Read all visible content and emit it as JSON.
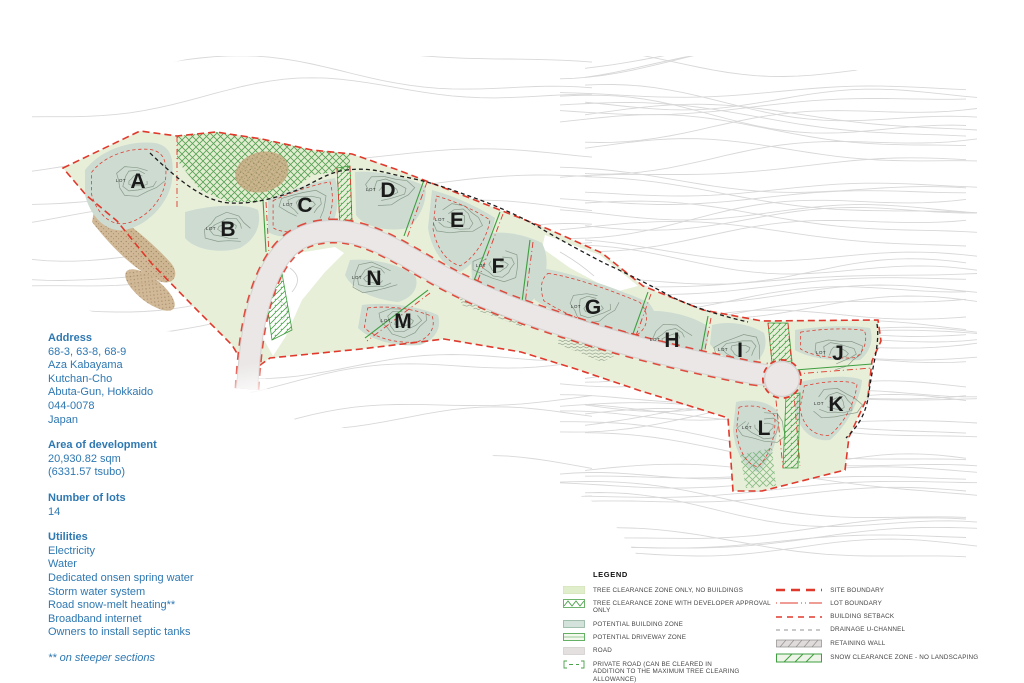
{
  "info_panel": {
    "address": {
      "title": "Address",
      "lines": [
        "68-3, 63-8, 68-9",
        "Aza Kabayama",
        "Kutchan-Cho",
        "Abuta-Gun, Hokkaido",
        "044-0078",
        "Japan"
      ]
    },
    "area": {
      "title": "Area of development",
      "lines": [
        "20,930.82 sqm",
        "(6331.57 tsubo)"
      ]
    },
    "number_of_lots": {
      "title": "Number of lots",
      "value": "14"
    },
    "utilities": {
      "title": "Utilities",
      "lines": [
        "Electricity",
        "Water",
        "Dedicated onsen spring water",
        "Storm water system",
        "Road snow-melt heating**",
        "Broadband internet",
        "Owners to install septic tanks"
      ]
    },
    "footnote": "** on steeper sections"
  },
  "legend": {
    "title": "LEGEND",
    "left_items": [
      {
        "label": "TREE CLEARANCE ZONE ONLY, NO BUILDINGS",
        "swatch": "tree-clearance-zone"
      },
      {
        "label": "TREE CLEARANCE ZONE WITH DEVELOPER APPROVAL ONLY",
        "swatch": "tree-clearance-developer-zone"
      },
      {
        "label": "POTENTIAL BUILDING ZONE",
        "swatch": "potential-building-zone"
      },
      {
        "label": "POTENTIAL DRIVEWAY ZONE",
        "swatch": "potential-driveway-zone"
      },
      {
        "label": "ROAD",
        "swatch": "road"
      },
      {
        "label": "PRIVATE ROAD (CAN BE CLEARED IN ADDITION TO THE MAXIMUM TREE CLEARING ALLOWANCE)",
        "swatch": "private-road"
      }
    ],
    "right_items": [
      {
        "label": "SITE BOUNDARY",
        "swatch": "site-boundary"
      },
      {
        "label": "LOT BOUNDARY",
        "swatch": "lot-boundary"
      },
      {
        "label": "BUILDING SETBACK",
        "swatch": "building-setback"
      },
      {
        "label": "DRAINAGE U-CHANNEL",
        "swatch": "drainage-u-channel"
      },
      {
        "label": "RETAINING WALL",
        "swatch": "retaining-wall"
      },
      {
        "label": "SNOW CLEARANCE ZONE - NO LANDSCAPING",
        "swatch": "snow-clearance-zone"
      }
    ]
  },
  "map": {
    "lot_prefix": "LOT",
    "lots": [
      "A",
      "B",
      "C",
      "D",
      "E",
      "F",
      "G",
      "H",
      "I",
      "J",
      "K",
      "L",
      "M",
      "N"
    ],
    "colors": {
      "text_blue": "#2e78b2",
      "boundary_red": "#e0392c",
      "hatch_green": "#4a9e4a",
      "building_zone": "#cddbd1",
      "tree_clearance": "#e7efd9",
      "road": "#eae7e6",
      "contour": "#d8d8d8"
    }
  }
}
